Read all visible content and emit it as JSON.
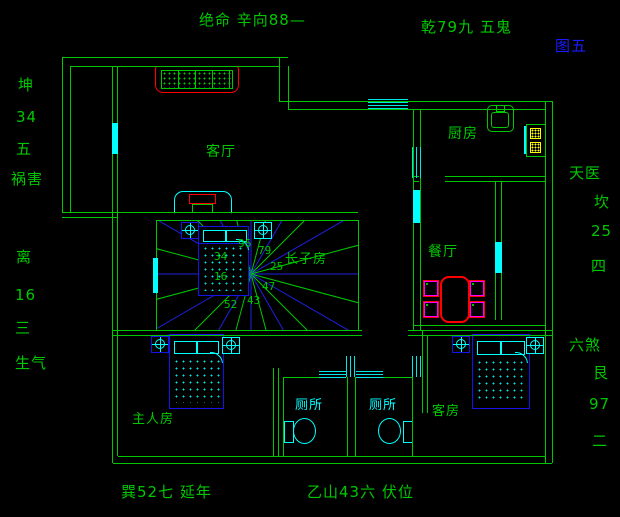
{
  "figure": {
    "label": "图五"
  },
  "annotations": {
    "top": "绝命 辛向88—",
    "top_right": "乾79九 五鬼",
    "left_upper": [
      "坤",
      "34",
      "五",
      "祸害"
    ],
    "left_lower": [
      "离",
      "16",
      "三",
      "生气"
    ],
    "right_upper": [
      "天医",
      "坎",
      "25",
      "四"
    ],
    "right_lower": [
      "六煞",
      "艮",
      "97",
      "二"
    ],
    "bottom_left": "巽52七 延年",
    "bottom_center": "乙山43六 伏位"
  },
  "rooms": {
    "living_room": "客厅",
    "kitchen": "厨房",
    "dining_room": "餐厅",
    "eldest_son_room": "长子房",
    "master_bedroom": "主人房",
    "toilet_left": "厕所",
    "toilet_right": "厕所",
    "guest_room": "客房"
  },
  "radial_numbers": [
    "96",
    "79",
    "25",
    "47",
    "43",
    "52",
    "34",
    "16"
  ],
  "colors": {
    "line_green": "#00C800",
    "cyan": "#00FFFF",
    "blue": "#2020E0",
    "red": "#FF0000",
    "yellow": "#FFFF00",
    "magenta": "#FF00FF",
    "figure_blue": "#1A1AFF"
  }
}
